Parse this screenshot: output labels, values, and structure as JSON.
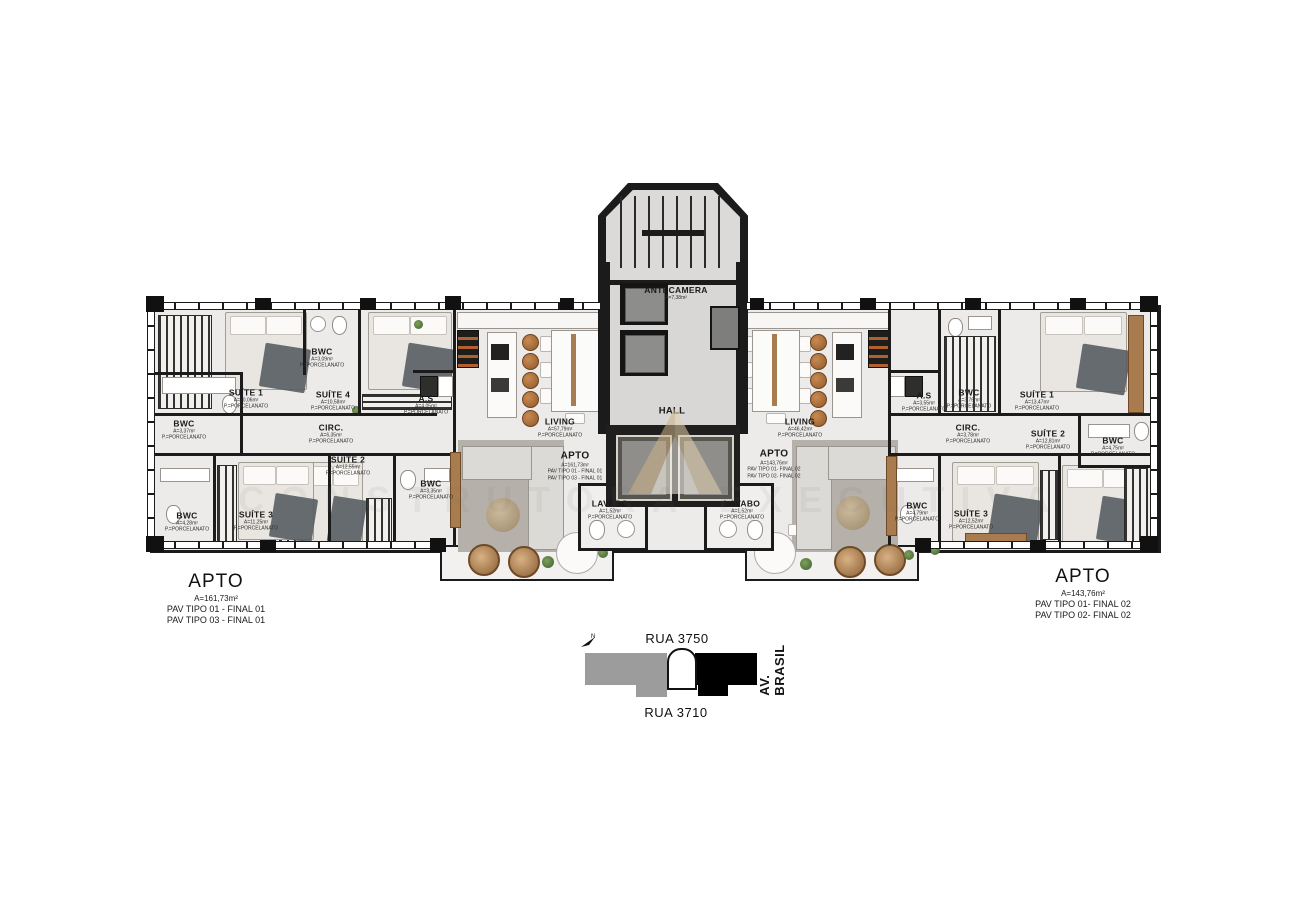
{
  "core": {
    "antecamera": {
      "name": "ANTECAMERA",
      "area": "A=7,38m²"
    },
    "hall": {
      "name": "HALL"
    }
  },
  "apt_left": {
    "summary": {
      "title": "APTO",
      "area": "A=161,73m²",
      "line1": "PAV TIPO 01 - FINAL 01",
      "line2": "PAV TIPO 03 - FINAL 01"
    },
    "rooms": {
      "suite1": {
        "name": "SUÍTE 1",
        "area": "A=20,06m²",
        "floor": "P.=PORCELANATO"
      },
      "bwc_suite4": {
        "name": "BWC",
        "area": "A=3,09m²",
        "floor": "P.=PORCELANATO"
      },
      "suite4": {
        "name": "SUÍTE 4",
        "area": "A=10,58m²",
        "floor": "P.=PORCELANATO"
      },
      "as": {
        "name": "A.S",
        "area": "A=4,05m²",
        "floor": "P.=PORCELANATO"
      },
      "bwc_left": {
        "name": "BWC",
        "area": "A=3,37m²",
        "floor": "P.=PORCELANATO"
      },
      "circ": {
        "name": "CIRC.",
        "area": "A=6,35m²",
        "floor": "P.=PORCELANATO"
      },
      "suite2": {
        "name": "SUÍTE 2",
        "area": "A=12,55m²",
        "floor": "P.=PORCELANATO"
      },
      "bwc_suite2": {
        "name": "BWC",
        "area": "A=3,35m²",
        "floor": "P.=PORCELANATO"
      },
      "suite3": {
        "name": "SUÍTE 3",
        "area": "A=11,25m²",
        "floor": "P.=PORCELANATO"
      },
      "bwc_suite3": {
        "name": "BWC",
        "area": "A=4,28m²",
        "floor": "P.=PORCELANATO"
      },
      "living": {
        "name": "LIVING",
        "area": "A=57,79m²",
        "floor": "P.=PORCELANATO"
      },
      "lavabo": {
        "name": "LAVABO",
        "area": "A=1,52m²",
        "floor": "P.=PORCELANATO"
      }
    }
  },
  "apt_right": {
    "summary": {
      "title": "APTO",
      "area": "A=143,76m²",
      "line1": "PAV TIPO 01- FINAL 02",
      "line2": "PAV TIPO 02- FINAL 02"
    },
    "rooms": {
      "as": {
        "name": "A.S",
        "area": "A=3,55m²",
        "floor": "P.=PORCELANATO"
      },
      "bwc_social": {
        "name": "BWC",
        "area": "A=3,76m²",
        "floor": "P.=PORCELANATO"
      },
      "suite1": {
        "name": "SUÍTE 1",
        "area": "A=13,47m²",
        "floor": "P.=PORCELANATO"
      },
      "circ": {
        "name": "CIRC.",
        "area": "A=3,78m²",
        "floor": "P.=PORCELANATO"
      },
      "suite2": {
        "name": "SUÍTE 2",
        "area": "A=12,81m²",
        "floor": "P.=PORCELANATO"
      },
      "bwc_suite2": {
        "name": "BWC",
        "area": "A=4,75m²",
        "floor": "P.=PORCELANATO"
      },
      "bwc_suite3": {
        "name": "BWC",
        "area": "A=4,79m²",
        "floor": "P.=PORCELANATO"
      },
      "suite3": {
        "name": "SUÍTE 3",
        "area": "A=12,52m²",
        "floor": "P.=PORCELANATO"
      },
      "living": {
        "name": "LIVING",
        "area": "A=46,42m²",
        "floor": "P.=PORCELANATO"
      },
      "lavabo": {
        "name": "LAVABO",
        "area": "A=1,52m²",
        "floor": "P.=PORCELANATO"
      }
    }
  },
  "site_map": {
    "north_label": "N",
    "street_top": "RUA 3750",
    "street_bottom": "RUA 3710",
    "avenue": "AV. BRASIL"
  },
  "watermark": {
    "text": "CONSTRUTORA EXECUTIVA"
  },
  "colors": {
    "wall": "#1b1b1b",
    "floor": "#ecebe9",
    "map_gray": "#9c9c9c",
    "map_black": "#000000",
    "wood": "#a97c50",
    "logo_tan": "#cdb287"
  }
}
